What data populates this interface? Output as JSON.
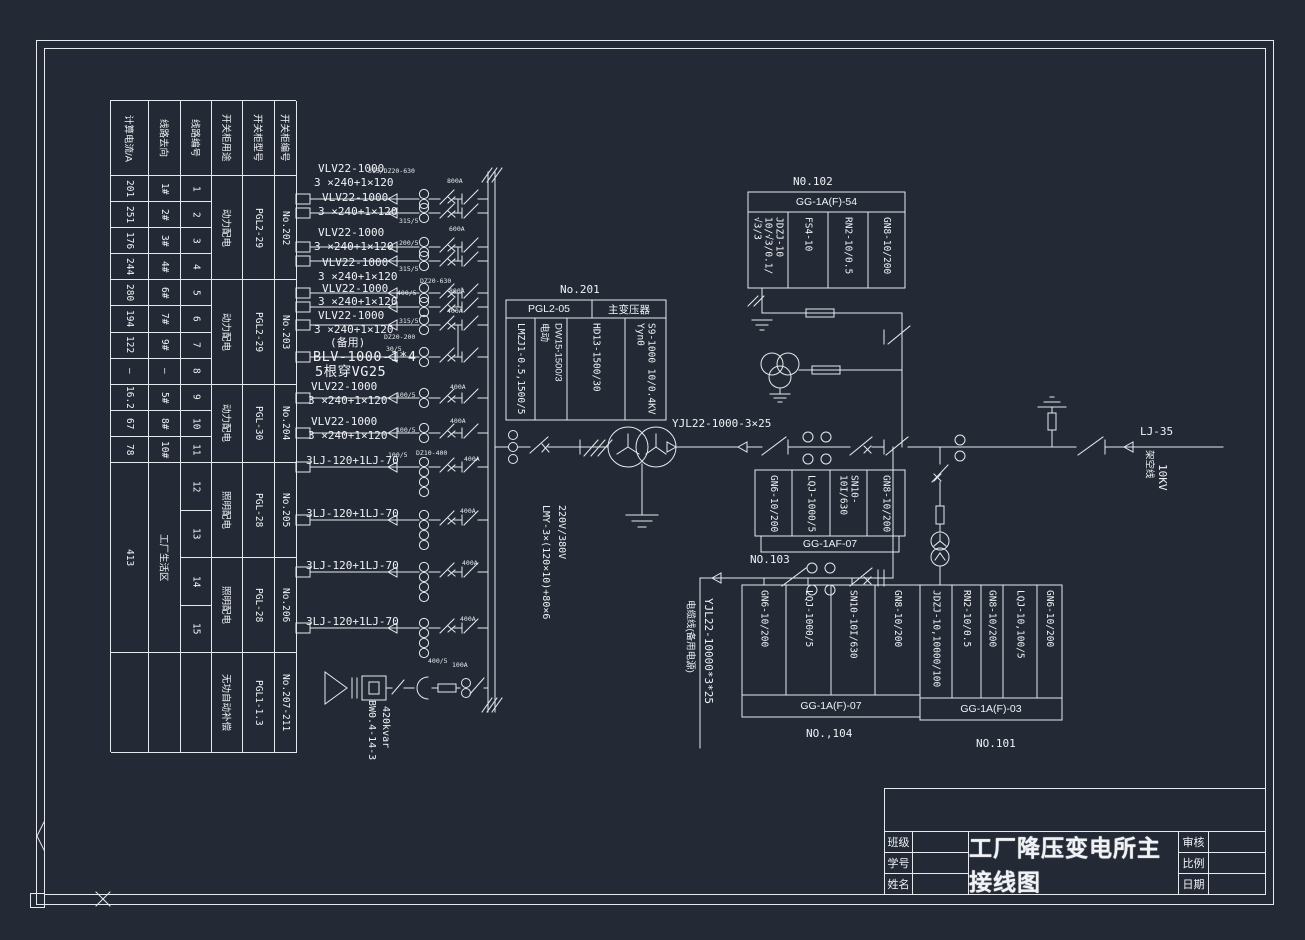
{
  "colors": {
    "bg": "#232a35",
    "line": "#e6e9ee",
    "text": "#f0f2f6"
  },
  "left_table": {
    "headers": [
      "计算电流/A",
      "线路去向",
      "线路编号",
      "开关柜用途",
      "开关柜型号",
      "开关柜编号"
    ],
    "rows": [
      {
        "current": "201",
        "dest": "1#",
        "no": "1"
      },
      {
        "current": "251",
        "dest": "2#",
        "no": "2"
      },
      {
        "current": "176",
        "dest": "3#",
        "no": "3"
      },
      {
        "current": "244",
        "dest": "4#",
        "no": "4"
      },
      {
        "current": "280",
        "dest": "6#",
        "no": "5"
      },
      {
        "current": "194",
        "dest": "7#",
        "no": "6"
      },
      {
        "current": "122",
        "dest": "9#",
        "no": "7"
      },
      {
        "current": "–",
        "dest": "–",
        "no": "8"
      },
      {
        "current": "16.2",
        "dest": "5#",
        "no": "9"
      },
      {
        "current": "67",
        "dest": "8#",
        "no": "10"
      },
      {
        "current": "78",
        "dest": "10#",
        "no": "11"
      }
    ],
    "tail_rows": [
      "12",
      "13",
      "14",
      "15"
    ],
    "tail_current": "413",
    "tail_dest": "工厂生活区",
    "groups": [
      {
        "use": "动力配电",
        "model": "PGL2-29",
        "cab": "No.202"
      },
      {
        "use": "动力配电",
        "model": "PGL2-29",
        "cab": "No.203"
      },
      {
        "use": "动力配电",
        "model": "PGL-30",
        "cab": "No.204"
      },
      {
        "use": "照明配电",
        "model": "PGL-28",
        "cab": "No.205"
      },
      {
        "use": "照明配电",
        "model": "PGL-28",
        "cab": "No.206"
      },
      {
        "use": "无功自动补偿",
        "model": "PGL1-1.3",
        "cab": "No.207-211"
      }
    ]
  },
  "equip_boxes": {
    "no201": {
      "tag": "No.201",
      "header": [
        "PGL2-05",
        "主变压器"
      ],
      "cols": [
        "LMZJ1-0.5,1500/5",
        "DW15-1500/3\n电动",
        "HD13-1500/30",
        "S9-1000 10/0.4KV\nYyn0"
      ]
    },
    "no102": {
      "tag": "N0.102",
      "label": "GG-1A(F)-54",
      "cols": [
        "JDZJ-10\n10/√3/0.1/√3/3",
        "FS4-10",
        "RN2-10/0.5",
        "GN8-10/200"
      ]
    },
    "no103": {
      "tag": "NO.103",
      "label": "GG-1AF-07",
      "cols": [
        "GN6-10/200",
        "LQJ-1000/5",
        "SN10-10I/630",
        "GN8-10/200"
      ]
    },
    "no104": {
      "tag": "NO.,104",
      "label": "GG-1A(F)-07",
      "cols": [
        "GN6-10/200",
        "LQJ-1000/5",
        "SN10-10I/630",
        "GN8-10/200"
      ]
    },
    "no101": {
      "tag": "NO.101",
      "label": "GG-1A(F)-03",
      "cols": [
        "JDZJ-10,10000/100",
        "RN2-10/0.5",
        "GN8-10/200",
        "LQJ-10,100/5",
        "GN6-10/200"
      ]
    }
  },
  "labels": [
    {
      "t": "VLV22-1000",
      "x": 318,
      "y": 163,
      "cls": "cab"
    },
    {
      "t": "3 ×240+1×120",
      "x": 314,
      "y": 177,
      "cls": "cab"
    },
    {
      "t": "VLV22-1000",
      "x": 322,
      "y": 192,
      "cls": "cab"
    },
    {
      "t": "3 ×240+1×120",
      "x": 318,
      "y": 206,
      "cls": "cab"
    },
    {
      "t": "VLV22-1000",
      "x": 318,
      "y": 227,
      "cls": "cab"
    },
    {
      "t": "3 ×240+1×120",
      "x": 314,
      "y": 241,
      "cls": "cab"
    },
    {
      "t": "VLV22-1000",
      "x": 322,
      "y": 257,
      "cls": "cab"
    },
    {
      "t": "3 ×240+1×120",
      "x": 318,
      "y": 271,
      "cls": "cab"
    },
    {
      "t": "VLV22-1000",
      "x": 322,
      "y": 283,
      "cls": "cab"
    },
    {
      "t": "3 ×240+1×120",
      "x": 318,
      "y": 296,
      "cls": "cab"
    },
    {
      "t": "VLV22-1000",
      "x": 318,
      "y": 310,
      "cls": "cab"
    },
    {
      "t": "3 ×240+1×120",
      "x": 314,
      "y": 324,
      "cls": "cab"
    },
    {
      "t": "(备用)",
      "x": 330,
      "y": 337,
      "cls": "cab"
    },
    {
      "t": "BLV-1000-1*4",
      "x": 313,
      "y": 350,
      "cls": "big"
    },
    {
      "t": "5根穿VG25",
      "x": 315,
      "y": 365,
      "cls": "big"
    },
    {
      "t": "VLV22-1000",
      "x": 311,
      "y": 381,
      "cls": "cab"
    },
    {
      "t": "3 ×240+1×120",
      "x": 308,
      "y": 395,
      "cls": "cab"
    },
    {
      "t": "VLV22-1000",
      "x": 311,
      "y": 416,
      "cls": "cab"
    },
    {
      "t": "3 ×240+1×120",
      "x": 308,
      "y": 430,
      "cls": "cab"
    },
    {
      "t": "3LJ-120+1LJ-70",
      "x": 306,
      "y": 455,
      "cls": "cab"
    },
    {
      "t": "3LJ-120+1LJ-70",
      "x": 306,
      "y": 508,
      "cls": "cab"
    },
    {
      "t": "3LJ-120+1LJ-70",
      "x": 306,
      "y": 560,
      "cls": "cab"
    },
    {
      "t": "3LJ-120+1LJ-70",
      "x": 306,
      "y": 616,
      "cls": "cab"
    },
    {
      "t": "No.201",
      "x": 560,
      "y": 284,
      "cls": "tag"
    },
    {
      "t": "YJL22-1000-3×25",
      "x": 672,
      "y": 418,
      "cls": "cab"
    },
    {
      "t": "LJ-35",
      "x": 1140,
      "y": 426,
      "cls": "tag"
    },
    {
      "t": "架空线",
      "x": 1143,
      "y": 450,
      "cls": "vc"
    },
    {
      "t": "10KV",
      "x": 1156,
      "y": 464,
      "cls": "vbig"
    },
    {
      "t": "220V/380V",
      "x": 556,
      "y": 505,
      "cls": "v"
    },
    {
      "t": "LMY-3×(120×10)+80×6",
      "x": 540,
      "y": 505,
      "cls": "v"
    },
    {
      "t": "YJL22-10000*3*25",
      "x": 702,
      "y": 598,
      "cls": "vbig"
    },
    {
      "t": "电缆线(备用电源)",
      "x": 684,
      "y": 600,
      "cls": "vc"
    },
    {
      "t": "BW0.4-14-3",
      "x": 366,
      "y": 700,
      "cls": "v"
    },
    {
      "t": "420kvar",
      "x": 380,
      "y": 706,
      "cls": "v"
    },
    {
      "t": "315/DZ20-630",
      "x": 368,
      "y": 168,
      "cls": "ann"
    },
    {
      "t": "800A",
      "x": 447,
      "y": 178,
      "cls": "ann"
    },
    {
      "t": "315/5",
      "x": 399,
      "y": 218,
      "cls": "ann"
    },
    {
      "t": "200/5",
      "x": 399,
      "y": 240,
      "cls": "ann"
    },
    {
      "t": "600A",
      "x": 449,
      "y": 226,
      "cls": "ann"
    },
    {
      "t": "315/5",
      "x": 399,
      "y": 266,
      "cls": "ann"
    },
    {
      "t": "400/5",
      "x": 397,
      "y": 290,
      "cls": "ann"
    },
    {
      "t": "DZ20-630",
      "x": 420,
      "y": 278,
      "cls": "ann"
    },
    {
      "t": "800A",
      "x": 449,
      "y": 288,
      "cls": "ann"
    },
    {
      "t": "315/5",
      "x": 399,
      "y": 318,
      "cls": "ann"
    },
    {
      "t": "DZ20-200",
      "x": 384,
      "y": 334,
      "cls": "ann"
    },
    {
      "t": "30/5",
      "x": 386,
      "y": 346,
      "cls": "ann"
    },
    {
      "t": "400A",
      "x": 447,
      "y": 308,
      "cls": "ann"
    },
    {
      "t": "100/5",
      "x": 396,
      "y": 392,
      "cls": "ann"
    },
    {
      "t": "400A",
      "x": 450,
      "y": 384,
      "cls": "ann"
    },
    {
      "t": "100/5",
      "x": 396,
      "y": 427,
      "cls": "ann"
    },
    {
      "t": "400A",
      "x": 450,
      "y": 418,
      "cls": "ann"
    },
    {
      "t": "100/5",
      "x": 388,
      "y": 452,
      "cls": "ann"
    },
    {
      "t": "DZ10-400",
      "x": 416,
      "y": 450,
      "cls": "ann"
    },
    {
      "t": "400A",
      "x": 464,
      "y": 456,
      "cls": "ann"
    },
    {
      "t": "400A",
      "x": 460,
      "y": 508,
      "cls": "ann"
    },
    {
      "t": "400A",
      "x": 462,
      "y": 560,
      "cls": "ann"
    },
    {
      "t": "400A",
      "x": 460,
      "y": 616,
      "cls": "ann"
    },
    {
      "t": "400/5",
      "x": 428,
      "y": 658,
      "cls": "ann"
    },
    {
      "t": "100A",
      "x": 452,
      "y": 662,
      "cls": "ann"
    }
  ],
  "title_block": {
    "title": "工厂降压变电所主接线图",
    "row_labels_left": [
      "班级",
      "学号",
      "姓名"
    ],
    "row_labels_right": [
      "审核",
      "比例",
      "日期"
    ]
  }
}
